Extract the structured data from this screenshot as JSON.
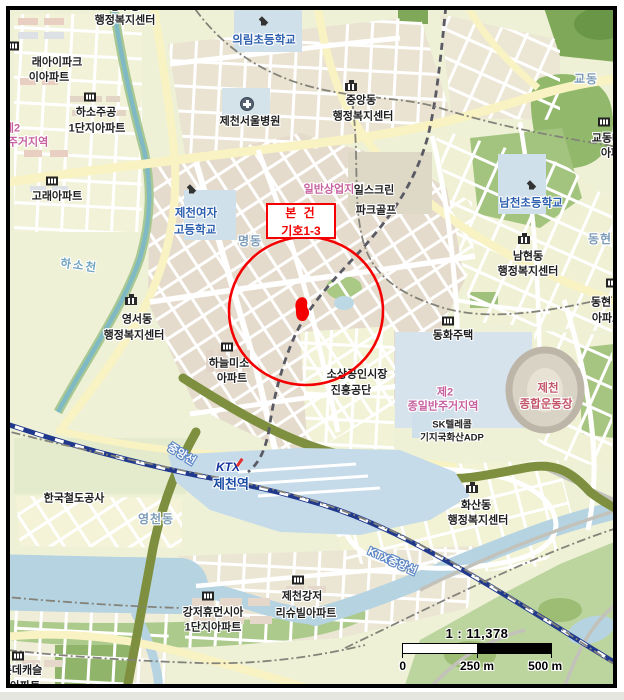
{
  "annotation": {
    "line1": "본 건",
    "line2": "기호1-3"
  },
  "scalebar": {
    "ratio": "1 : 11,378",
    "tick0": "0",
    "tick250": "250 m",
    "tick500": "500 m"
  },
  "map": {
    "accent_red": "#f40000",
    "labels": [
      {
        "text": "용두동",
        "x": 125,
        "y": 7,
        "cls": "blk",
        "name": "label-top-admin-dong"
      },
      {
        "text": "행정복지센터",
        "x": 125,
        "y": 21,
        "cls": "blk",
        "name": "label-top-admin-center"
      },
      {
        "text": "의림초등학교",
        "x": 264,
        "y": 41,
        "cls": "school",
        "name": "label-uirim-elementary"
      },
      {
        "text": "래아이파크",
        "x": 57,
        "y": 63,
        "cls": "blk",
        "name": "label-raeipark-apt"
      },
      {
        "text": "이아파트",
        "x": 49,
        "y": 78,
        "cls": "blk",
        "name": "label-raeipark-apt2"
      },
      {
        "text": "하소주공",
        "x": 96,
        "y": 113,
        "cls": "blk",
        "name": "label-haso-jugong"
      },
      {
        "text": "1단지아파트",
        "x": 97,
        "y": 129,
        "cls": "blk",
        "name": "label-haso-jugong2"
      },
      {
        "text": "제2",
        "x": 12,
        "y": 129,
        "cls": "pink",
        "name": "label-zone-res-left1"
      },
      {
        "text": "주거지역",
        "x": 28,
        "y": 143,
        "cls": "pink",
        "name": "label-zone-res-left2"
      },
      {
        "text": "고래아파트",
        "x": 57,
        "y": 197,
        "cls": "blk",
        "name": "label-gorae-apt"
      },
      {
        "text": "제천서울병원",
        "x": 250,
        "y": 122,
        "cls": "blk",
        "name": "label-jecheon-seoul-hospital"
      },
      {
        "text": "중앙동",
        "x": 361,
        "y": 101,
        "cls": "blk",
        "name": "label-jungang-dong"
      },
      {
        "text": "행정복지센터",
        "x": 363,
        "y": 117,
        "cls": "blk",
        "name": "label-jungang-admin-center"
      },
      {
        "text": "교동",
        "x": 586,
        "y": 79,
        "cls": "dong",
        "name": "label-gyo-dong"
      },
      {
        "text": "교동대원",
        "x": 612,
        "y": 139,
        "cls": "blk",
        "name": "label-gyodong-apt1"
      },
      {
        "text": "아파트",
        "x": 616,
        "y": 154,
        "cls": "blk",
        "name": "label-gyodong-apt2"
      },
      {
        "text": "일반상업지역",
        "x": 334,
        "y": 190,
        "cls": "pink",
        "name": "label-zone-commercial"
      },
      {
        "text": "일스크린",
        "x": 374,
        "y": 191,
        "cls": "blk",
        "name": "label-screen-parkgolf1"
      },
      {
        "text": "파크골프",
        "x": 376,
        "y": 211,
        "cls": "blk",
        "name": "label-screen-parkgolf2"
      },
      {
        "text": "제천여자",
        "x": 196,
        "y": 214,
        "cls": "school",
        "name": "label-jecheon-girls-hs1"
      },
      {
        "text": "고등학교",
        "x": 195,
        "y": 231,
        "cls": "school",
        "name": "label-jecheon-girls-hs2"
      },
      {
        "text": "명동",
        "x": 250,
        "y": 241,
        "cls": "dong",
        "name": "label-myeong-dong"
      },
      {
        "text": "남천초등학교",
        "x": 531,
        "y": 204,
        "cls": "school",
        "name": "label-namcheon-elementary"
      },
      {
        "text": "남현동",
        "x": 528,
        "y": 257,
        "cls": "blk",
        "name": "label-namhyeon-dong"
      },
      {
        "text": "행정복지센터",
        "x": 528,
        "y": 272,
        "cls": "blk",
        "name": "label-namhyeon-admin-center"
      },
      {
        "text": "동현",
        "x": 600,
        "y": 239,
        "cls": "dong",
        "name": "label-donghyeon-dong"
      },
      {
        "text": "하소천",
        "x": 79,
        "y": 267,
        "cls": "stream",
        "rot": 8,
        "name": "label-hasocheon-stream"
      },
      {
        "text": "영서동",
        "x": 137,
        "y": 320,
        "cls": "blk",
        "name": "label-yeongseo-dong"
      },
      {
        "text": "행정복지센터",
        "x": 134,
        "y": 336,
        "cls": "blk",
        "name": "label-yeongseo-admin-center"
      },
      {
        "text": "동현",
        "x": 601,
        "y": 303,
        "cls": "blk",
        "name": "label-donghyeon-apt1"
      },
      {
        "text": "아파트",
        "x": 607,
        "y": 319,
        "cls": "blk",
        "name": "label-donghyeon-apt2"
      },
      {
        "text": "동화주택",
        "x": 453,
        "y": 336,
        "cls": "blk",
        "name": "label-donghwa-jutaek"
      },
      {
        "text": "하늘미소",
        "x": 229,
        "y": 364,
        "cls": "blk",
        "name": "label-haneulmiso-apt1"
      },
      {
        "text": "아파트",
        "x": 232,
        "y": 379,
        "cls": "blk",
        "name": "label-haneulmiso-apt2"
      },
      {
        "text": "소상공인시장",
        "x": 357,
        "y": 375,
        "cls": "blk",
        "name": "label-sosanggongin1"
      },
      {
        "text": "진흥공단",
        "x": 351,
        "y": 391,
        "cls": "blk",
        "name": "label-sosanggongin2"
      },
      {
        "text": "제2",
        "x": 445,
        "y": 393,
        "cls": "pink",
        "name": "label-zone-res2-1"
      },
      {
        "text": "종일반주거지역",
        "x": 443,
        "y": 407,
        "cls": "pink",
        "name": "label-zone-res2-2"
      },
      {
        "text": "제천",
        "x": 548,
        "y": 389,
        "cls": "stadium",
        "name": "label-jecheon-stadium1"
      },
      {
        "text": "종합운동장",
        "x": 546,
        "y": 405,
        "cls": "stadium",
        "name": "label-jecheon-stadium2"
      },
      {
        "text": "SK텔레콤",
        "x": 452,
        "y": 425,
        "cls": "blk small",
        "name": "label-sk-telecom1"
      },
      {
        "text": "기지국화산ADP",
        "x": 452,
        "y": 438,
        "cls": "blk small",
        "name": "label-sk-telecom2"
      },
      {
        "text": "중앙선",
        "x": 181,
        "y": 455,
        "cls": "rail",
        "rot": 32,
        "name": "label-jungang-line"
      },
      {
        "text": "KTX",
        "x": 228,
        "y": 467,
        "cls": "ktx",
        "name": "label-ktx-logo"
      },
      {
        "text": "제천역",
        "x": 231,
        "y": 484,
        "cls": "station",
        "name": "label-jecheon-station"
      },
      {
        "text": "한국철도공사",
        "x": 74,
        "y": 499,
        "cls": "blk",
        "name": "label-korail"
      },
      {
        "text": "영천동",
        "x": 156,
        "y": 519,
        "cls": "dong",
        "name": "label-yeongcheon-dong"
      },
      {
        "text": "KTX중앙선",
        "x": 392,
        "y": 562,
        "cls": "rail",
        "rot": 24,
        "name": "label-ktx-jungang-line"
      },
      {
        "text": "화산동",
        "x": 476,
        "y": 506,
        "cls": "blk",
        "name": "label-hwasan-dong"
      },
      {
        "text": "행정복지센터",
        "x": 478,
        "y": 521,
        "cls": "blk",
        "name": "label-hwasan-admin-center"
      },
      {
        "text": "제천강저",
        "x": 302,
        "y": 597,
        "cls": "blk",
        "name": "label-gangjeo-leesuvill1"
      },
      {
        "text": "리슈빌아파트",
        "x": 306,
        "y": 614,
        "cls": "blk",
        "name": "label-gangjeo-leesuvill2"
      },
      {
        "text": "강저휴먼시아",
        "x": 213,
        "y": 613,
        "cls": "blk",
        "name": "label-gangjeo-humansia1"
      },
      {
        "text": "1단지아파트",
        "x": 213,
        "y": 628,
        "cls": "blk",
        "name": "label-gangjeo-humansia2"
      },
      {
        "text": "롯데캐슬",
        "x": 22,
        "y": 671,
        "cls": "blk",
        "name": "label-lotte-castle1"
      },
      {
        "text": "이아파트",
        "x": 20,
        "y": 687,
        "cls": "blk",
        "name": "label-lotte-castle2"
      }
    ],
    "icons": [
      {
        "type": "school",
        "x": 264,
        "y": 22
      },
      {
        "type": "school",
        "x": 192,
        "y": 190
      },
      {
        "type": "school",
        "x": 532,
        "y": 186
      },
      {
        "type": "hospital",
        "x": 247,
        "y": 104
      },
      {
        "type": "gov",
        "x": 351,
        "y": 87
      },
      {
        "type": "gov",
        "x": 131,
        "y": 301
      },
      {
        "type": "gov",
        "x": 524,
        "y": 240
      },
      {
        "type": "gov",
        "x": 472,
        "y": 489
      },
      {
        "type": "apt",
        "x": 13,
        "y": 46
      },
      {
        "type": "apt",
        "x": 90,
        "y": 97
      },
      {
        "type": "apt",
        "x": 52,
        "y": 181
      },
      {
        "type": "apt",
        "x": 604,
        "y": 122
      },
      {
        "type": "apt",
        "x": 612,
        "y": 283
      },
      {
        "type": "apt",
        "x": 448,
        "y": 321
      },
      {
        "type": "apt",
        "x": 227,
        "y": 347
      },
      {
        "type": "apt",
        "x": 208,
        "y": 596
      },
      {
        "type": "apt",
        "x": 298,
        "y": 580
      },
      {
        "type": "apt",
        "x": 18,
        "y": 656
      }
    ]
  }
}
